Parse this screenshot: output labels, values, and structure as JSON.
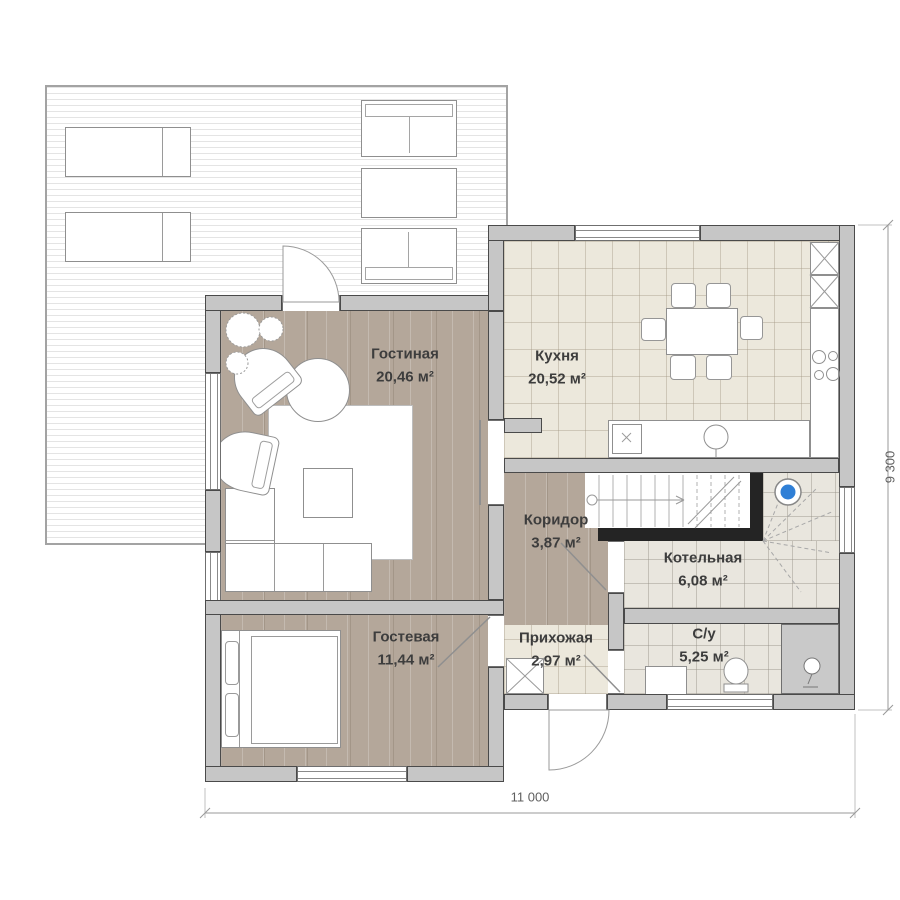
{
  "plan": {
    "rooms": [
      {
        "id": "living",
        "name": "Гостиная",
        "area": "20,46 м²"
      },
      {
        "id": "kitchen",
        "name": "Кухня",
        "area": "20,52 м²"
      },
      {
        "id": "corridor",
        "name": "Коридор",
        "area": "3,87 м²"
      },
      {
        "id": "boiler",
        "name": "Котельная",
        "area": "6,08 м²"
      },
      {
        "id": "guest",
        "name": "Гостевая",
        "area": "11,44 м²"
      },
      {
        "id": "hall",
        "name": "Прихожая",
        "area": "2,97 м²"
      },
      {
        "id": "bathroom",
        "name": "С/у",
        "area": "5,25 м²"
      }
    ],
    "dimensions": {
      "width_label": "11 000",
      "height_label": "9 300"
    },
    "colors": {
      "wall_fill": "#c6c6c6",
      "wall_outline": "#4a4a4a",
      "wood_floor": "#b4a79a",
      "tile_floor": "#ece8dc",
      "utility_tile": "#e9e6de",
      "shower_zone": "#c9c9c9",
      "stair_wall": "#242424",
      "boiler_accent": "#2f7fd6"
    }
  }
}
